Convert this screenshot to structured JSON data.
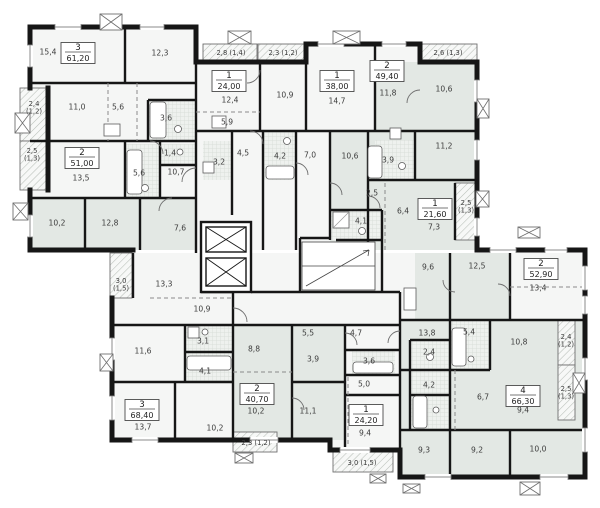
{
  "plan": {
    "type": "residential-floor-plan",
    "colors": {
      "wall": "#161616",
      "room_light": "#f5f6f5",
      "room_shaded": "#e3e8e4",
      "bath_fill": "#eef1ee",
      "hatch_line": "#b9bfb9",
      "label_text": "#3c3c3c"
    },
    "apartments": [
      {
        "rooms": "3",
        "area": "61,20",
        "x": 78,
        "y": 53
      },
      {
        "rooms": "2",
        "area": "51,00",
        "x": 82,
        "y": 158
      },
      {
        "rooms": "1",
        "area": "24,00",
        "x": 229,
        "y": 81
      },
      {
        "rooms": "1",
        "area": "38,00",
        "x": 337,
        "y": 81
      },
      {
        "rooms": "2",
        "area": "49,40",
        "x": 387,
        "y": 71
      },
      {
        "rooms": "1",
        "area": "21,60",
        "x": 435,
        "y": 209
      },
      {
        "rooms": "2",
        "area": "52,90",
        "x": 541,
        "y": 269
      },
      {
        "rooms": "3",
        "area": "68,40",
        "x": 142,
        "y": 410
      },
      {
        "rooms": "2",
        "area": "40,70",
        "x": 257,
        "y": 394
      },
      {
        "rooms": "1",
        "area": "24,20",
        "x": 366,
        "y": 415
      },
      {
        "rooms": "4",
        "area": "66,30",
        "x": 523,
        "y": 396
      }
    ],
    "room_labels": [
      {
        "t": "15,4",
        "x": 48,
        "y": 52
      },
      {
        "t": "12,3",
        "x": 160,
        "y": 53
      },
      {
        "t": "11,0",
        "x": 77,
        "y": 107
      },
      {
        "t": "5,6",
        "x": 118,
        "y": 107
      },
      {
        "t": "3,6",
        "x": 166,
        "y": 118
      },
      {
        "t": "1,4",
        "x": 170,
        "y": 153
      },
      {
        "t": "13,5",
        "x": 81,
        "y": 178
      },
      {
        "t": "5,6",
        "x": 139,
        "y": 173
      },
      {
        "t": "10,7",
        "x": 176,
        "y": 172
      },
      {
        "t": "10,2",
        "x": 57,
        "y": 223
      },
      {
        "t": "12,8",
        "x": 110,
        "y": 223
      },
      {
        "t": "7,6",
        "x": 180,
        "y": 228
      },
      {
        "t": "12,4",
        "x": 230,
        "y": 100
      },
      {
        "t": "5,9",
        "x": 227,
        "y": 122
      },
      {
        "t": "4,5",
        "x": 243,
        "y": 153
      },
      {
        "t": "3,2",
        "x": 219,
        "y": 162
      },
      {
        "t": "10,9",
        "x": 285,
        "y": 95
      },
      {
        "t": "14,7",
        "x": 337,
        "y": 101
      },
      {
        "t": "4,2",
        "x": 280,
        "y": 156
      },
      {
        "t": "7,0",
        "x": 310,
        "y": 155
      },
      {
        "t": "11,8",
        "x": 388,
        "y": 93
      },
      {
        "t": "10,6",
        "x": 350,
        "y": 156
      },
      {
        "t": "10,6",
        "x": 444,
        "y": 89
      },
      {
        "t": "3,9",
        "x": 388,
        "y": 160
      },
      {
        "t": "11,2",
        "x": 444,
        "y": 146
      },
      {
        "t": "2,5",
        "x": 372,
        "y": 193
      },
      {
        "t": "4,1",
        "x": 361,
        "y": 221
      },
      {
        "t": "6,4",
        "x": 403,
        "y": 211
      },
      {
        "t": "7,3",
        "x": 434,
        "y": 227
      },
      {
        "t": "9,6",
        "x": 428,
        "y": 267
      },
      {
        "t": "12,5",
        "x": 477,
        "y": 266
      },
      {
        "t": "13,4",
        "x": 538,
        "y": 288
      },
      {
        "t": "13,3",
        "x": 164,
        "y": 284
      },
      {
        "t": "10,9",
        "x": 202,
        "y": 309
      },
      {
        "t": "11,6",
        "x": 143,
        "y": 351
      },
      {
        "t": "3,1",
        "x": 203,
        "y": 341
      },
      {
        "t": "4,1",
        "x": 205,
        "y": 371
      },
      {
        "t": "13,7",
        "x": 143,
        "y": 427
      },
      {
        "t": "10,2",
        "x": 215,
        "y": 428
      },
      {
        "t": "8,8",
        "x": 254,
        "y": 349
      },
      {
        "t": "5,5",
        "x": 308,
        "y": 333
      },
      {
        "t": "3,9",
        "x": 313,
        "y": 359
      },
      {
        "t": "10,2",
        "x": 256,
        "y": 411
      },
      {
        "t": "11,1",
        "x": 308,
        "y": 411
      },
      {
        "t": "4,7",
        "x": 356,
        "y": 333
      },
      {
        "t": "3,6",
        "x": 369,
        "y": 361
      },
      {
        "t": "5,0",
        "x": 364,
        "y": 384
      },
      {
        "t": "9,4",
        "x": 365,
        "y": 433
      },
      {
        "t": "13,8",
        "x": 427,
        "y": 333
      },
      {
        "t": "5,4",
        "x": 469,
        "y": 332
      },
      {
        "t": "10,8",
        "x": 519,
        "y": 342
      },
      {
        "t": "2,4",
        "x": 429,
        "y": 352
      },
      {
        "t": "4,2",
        "x": 429,
        "y": 385
      },
      {
        "t": "6,7",
        "x": 483,
        "y": 397
      },
      {
        "t": "9,4",
        "x": 523,
        "y": 410
      },
      {
        "t": "9,3",
        "x": 424,
        "y": 450
      },
      {
        "t": "9,2",
        "x": 477,
        "y": 450
      },
      {
        "t": "10,0",
        "x": 538,
        "y": 449
      }
    ],
    "balconies": [
      {
        "x": 20,
        "y": 88,
        "w": 28,
        "h": 53,
        "lines": [
          "2,4",
          "(1,2)"
        ],
        "lx": 34,
        "ly": 106
      },
      {
        "x": 20,
        "y": 141,
        "w": 28,
        "h": 49,
        "lines": [
          "2,5",
          "(1,3)"
        ],
        "lx": 32,
        "ly": 153
      },
      {
        "x": 203,
        "y": 44,
        "w": 54,
        "h": 18,
        "lines": [
          "2,8 (1,4)"
        ],
        "lx": 231,
        "ly": 55
      },
      {
        "x": 258,
        "y": 44,
        "w": 50,
        "h": 18,
        "lines": [
          "2,3 (1,2)"
        ],
        "lx": 283,
        "ly": 55
      },
      {
        "x": 420,
        "y": 44,
        "w": 57,
        "h": 18,
        "lines": [
          "2,6 (1,3)"
        ],
        "lx": 448,
        "ly": 55
      },
      {
        "x": 455,
        "y": 183,
        "w": 22,
        "h": 57,
        "lines": [
          "2,5",
          "(1,3)"
        ],
        "lx": 466,
        "ly": 205
      },
      {
        "x": 110,
        "y": 253,
        "w": 22,
        "h": 45,
        "lines": [
          "3,0",
          "(1,5)"
        ],
        "lx": 121,
        "ly": 283
      },
      {
        "x": 233,
        "y": 432,
        "w": 44,
        "h": 20,
        "lines": [
          "2,3 (1,2)"
        ],
        "lx": 256,
        "ly": 445
      },
      {
        "x": 333,
        "y": 452,
        "w": 60,
        "h": 20,
        "lines": [
          "3,0 (1,5)"
        ],
        "lx": 362,
        "ly": 465
      },
      {
        "x": 558,
        "y": 320,
        "w": 17,
        "h": 45,
        "lines": [
          "2,4",
          "(1,2)"
        ],
        "lx": 566,
        "ly": 339
      },
      {
        "x": 558,
        "y": 365,
        "w": 17,
        "h": 55,
        "lines": [
          "2,5",
          "(1,3)"
        ],
        "lx": 566,
        "ly": 391
      }
    ],
    "vent_markers": [
      {
        "x": 100,
        "y": 14,
        "w": 22,
        "h": 16
      },
      {
        "x": 228,
        "y": 31,
        "w": 23,
        "h": 13
      },
      {
        "x": 333,
        "y": 31,
        "w": 27,
        "h": 13
      },
      {
        "x": 15,
        "y": 113,
        "w": 15,
        "h": 20
      },
      {
        "x": 13,
        "y": 203,
        "w": 15,
        "h": 17
      },
      {
        "x": 100,
        "y": 354,
        "w": 13,
        "h": 17
      },
      {
        "x": 477,
        "y": 99,
        "w": 12,
        "h": 19
      },
      {
        "x": 476,
        "y": 191,
        "w": 13,
        "h": 16
      },
      {
        "x": 573,
        "y": 373,
        "w": 12,
        "h": 20
      },
      {
        "x": 518,
        "y": 227,
        "w": 22,
        "h": 11
      },
      {
        "x": 235,
        "y": 453,
        "w": 18,
        "h": 10
      },
      {
        "x": 370,
        "y": 474,
        "w": 16,
        "h": 9
      },
      {
        "x": 403,
        "y": 484,
        "w": 17,
        "h": 9
      },
      {
        "x": 520,
        "y": 482,
        "w": 20,
        "h": 13
      }
    ]
  }
}
